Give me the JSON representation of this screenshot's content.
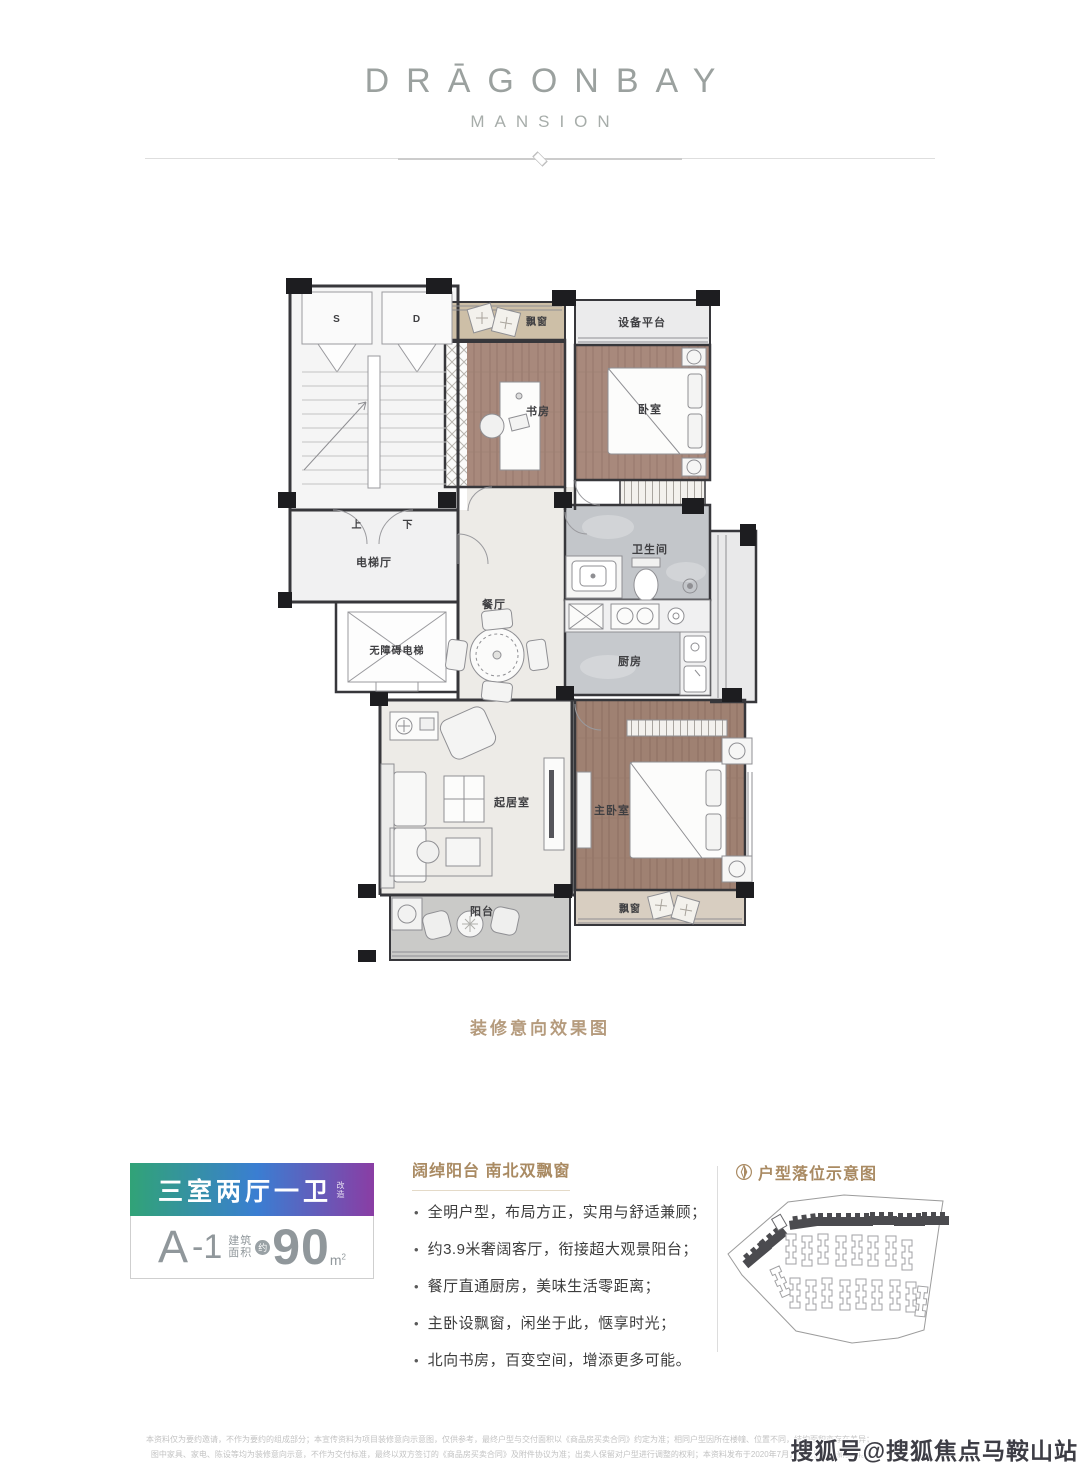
{
  "logo": {
    "title": "DRĀGONBAY",
    "subtitle": "MANSION"
  },
  "floorplan": {
    "caption": "装修意向效果图",
    "labels": {
      "s": "S",
      "d": "D",
      "up": "上",
      "down": "下",
      "elevator_hall": "电梯厅",
      "accessible_elevator": "无障碍电梯",
      "bay_window_top": "飘窗",
      "study": "书房",
      "equipment_platform": "设备平台",
      "bedroom": "卧室",
      "bathroom": "卫生间",
      "kitchen": "厨房",
      "dining": "餐厅",
      "living": "起居室",
      "master_bedroom": "主卧室",
      "bay_window_bottom": "飘窗",
      "balcony": "阳台"
    }
  },
  "badge": {
    "title": "三室两厅一卫",
    "title_note": "改造",
    "unit_name": "A",
    "unit_suffix": "-1",
    "area_label_line1": "建筑",
    "area_label_line2": "面积",
    "approx": "约",
    "area_value": "90",
    "area_unit_base": "m",
    "area_unit_sup": "2"
  },
  "features": {
    "heading": "阔绰阳台 南北双飘窗",
    "bullets": [
      "全明户型，布局方正，实用与舒适兼顾；",
      "约3.9米奢阔客厅，衔接超大观景阳台；",
      "餐厅直通厨房，美味生活零距离；",
      "主卧设飘窗，闲坐于此，惬享时光；",
      "北向书房，百变空间，增添更多可能。"
    ]
  },
  "sitemap": {
    "heading": "户型落位示意图"
  },
  "disclaimer": {
    "line1": "本资料仅为要约邀请，不作为要约的组成部分；本宣传资料为项目装修意向示意图，仅供参考，最终户型与交付面积以《商品房买卖合同》约定为准；相同户型因所在楼幢、位置不同，结构面积亦存在差异；",
    "line2": "图中家具、家电、陈设等均为装修意向示意，不作为交付标准，最终以双方签订的《商品房买卖合同》及附件协议为准；出卖人保留对户型进行调整的权利；本资料发布于2020年7月，敬请留意最新资料。"
  },
  "watermark": "搜狐号@搜狐焦点马鞍山站",
  "colors": {
    "accent_brown": "#a98a62",
    "gradient_from": "#31a377",
    "gradient_mid": "#3a7ed2",
    "gradient_to": "#8a3da4",
    "caption_tan": "#b59b7d",
    "wood": "#a8897c",
    "tile_gray": "#c3c6ca"
  }
}
